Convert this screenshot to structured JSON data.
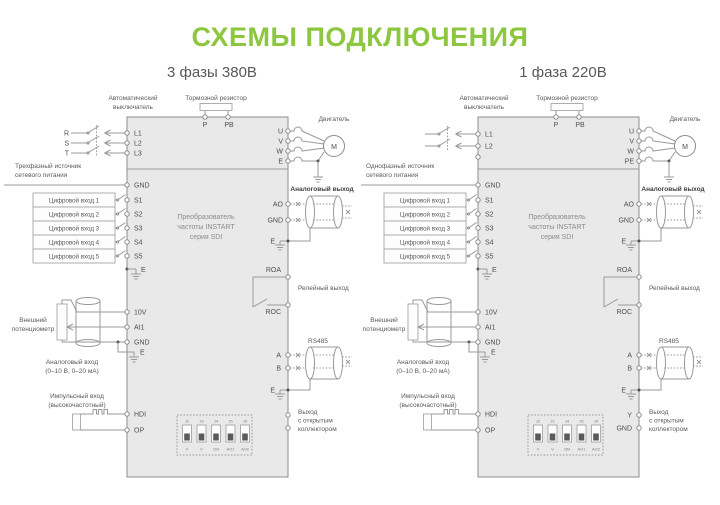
{
  "page": {
    "title": "СХЕМЫ ПОДКЛЮЧЕНИЯ"
  },
  "colors": {
    "accent_green": "#8dc63f",
    "line_gray": "#9a9a9a",
    "box_fill": "#e9e9e9",
    "text_dark": "#4e4e4e"
  },
  "diagrams": [
    {
      "subtitle": "3 фазы 380В",
      "brake": "Тормозной резистор",
      "breaker": [
        "Автоматический",
        "выключатель"
      ],
      "phases": [
        "R",
        "S",
        "T"
      ],
      "inputs": [
        "L1",
        "L2",
        "L3"
      ],
      "source": [
        "Трехфазный источник",
        "сетевого питания"
      ],
      "top": [
        "P",
        "PB"
      ],
      "motor": {
        "label": "Двигатель",
        "letter": "М",
        "terms": [
          "U",
          "V",
          "W",
          "E"
        ]
      },
      "gnd": "GND",
      "din": [
        "Цифровой вход 1",
        "Цифровой вход 2",
        "Цифровой вход 3",
        "Цифровой вход 4",
        "Цифровой вход 5"
      ],
      "s": [
        "S1",
        "S2",
        "S3",
        "S4",
        "S5"
      ],
      "e": "E",
      "conv": [
        "Преобразователь",
        "частоты INSTART",
        "серия SDI"
      ],
      "aout": {
        "label": "Аналоговый выход",
        "terms": [
          "AO",
          "GND"
        ],
        "e": "E"
      },
      "relay": {
        "label": "Релейный выход",
        "terms": [
          "ROA",
          "ROC"
        ]
      },
      "rs485": {
        "label": "RS485",
        "terms": [
          "A",
          "B"
        ],
        "e": "E"
      },
      "oc": {
        "label": [
          "Выход",
          "с открытым",
          "коллектором"
        ],
        "terms": [
          "",
          ""
        ]
      },
      "pot": {
        "label": [
          "Внешний",
          "потенциометр"
        ]
      },
      "ain": {
        "terms": [
          "10V",
          "AI1",
          "GND"
        ],
        "e": "E",
        "label": [
          "Аналоговый вход",
          "(0–10 В, 0–20 мА)"
        ]
      },
      "pulse": {
        "label": [
          "Импульсный вход",
          "(высокочастотный)"
        ],
        "terms": [
          "HDI",
          "OP"
        ]
      },
      "dip": {
        "top": [
          "J2",
          "J3",
          "J4",
          "J5",
          "J9"
        ],
        "bottom": [
          "V",
          "V",
          "ON",
          "AO1",
          "AO2"
        ]
      }
    },
    {
      "subtitle": "1 фаза 220В",
      "brake": "Тормозной резистор",
      "breaker": [
        "Автоматический",
        "выключатель"
      ],
      "phases": [],
      "inputs": [
        "L1",
        "L2"
      ],
      "source": [
        "Однофазный источник",
        "сетевого питания"
      ],
      "top": [
        "P",
        "PB"
      ],
      "motor": {
        "label": "Двигатель",
        "letter": "М",
        "terms": [
          "U",
          "V",
          "W",
          "PE"
        ]
      },
      "gnd": "GND",
      "din": [
        "Цифровой вход 1",
        "Цифровой вход 2",
        "Цифровой вход 3",
        "Цифровой вход 4",
        "Цифровой вход 5"
      ],
      "s": [
        "S1",
        "S2",
        "S3",
        "S4",
        "S5"
      ],
      "e": "E",
      "conv": [
        "Преобразователь",
        "частоты INSTART",
        "серия SDI"
      ],
      "aout": {
        "label": "Аналоговый выход",
        "terms": [
          "AO",
          "GND"
        ],
        "e": "E"
      },
      "relay": {
        "label": "Релейный выход",
        "terms": [
          "ROA",
          "ROC"
        ]
      },
      "rs485": {
        "label": "RS485",
        "terms": [
          "A",
          "B"
        ],
        "e": "E"
      },
      "oc": {
        "label": [
          "Выход",
          "с открытым",
          "коллектором"
        ],
        "terms": [
          "Y",
          "GND"
        ]
      },
      "pot": {
        "label": [
          "Внешний",
          "потенциометр"
        ]
      },
      "ain": {
        "terms": [
          "10V",
          "AI1",
          "GND"
        ],
        "e": "E",
        "label": [
          "Аналоговый вход",
          "(0–10 В, 0–20 мА)"
        ]
      },
      "pulse": {
        "label": [
          "Импульсный вход",
          "(высокочастотный)"
        ],
        "terms": [
          "HDI",
          "OP"
        ]
      },
      "dip": {
        "top": [
          "J2",
          "J3",
          "J4",
          "J5",
          "J9"
        ],
        "bottom": [
          "V",
          "V",
          "ON",
          "AO1",
          "AO2"
        ]
      }
    }
  ]
}
